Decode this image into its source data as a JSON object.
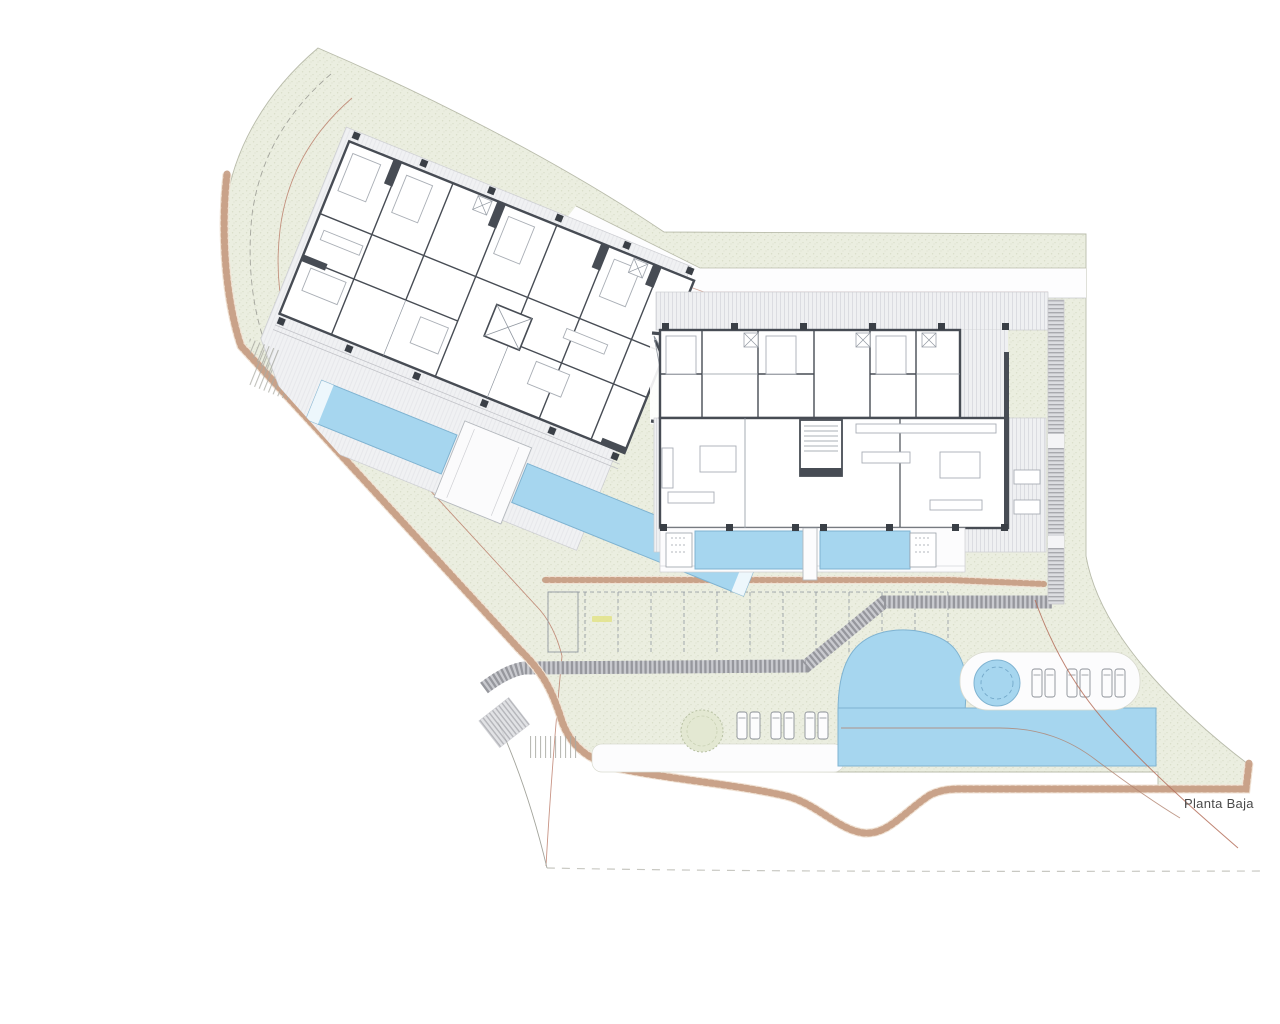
{
  "drawing": {
    "title": "Planta Baja"
  },
  "colors": {
    "paper": "#ffffff",
    "green": "#ebeee0",
    "greendot": "#d7dcc6",
    "greenedge": "#b9bcab",
    "platform": "#f0f1f3",
    "platedge": "#c8c9ce",
    "deck": "#eff0f2",
    "deckline": "#dbdce1",
    "wall": "#474c54",
    "wallsoft": "#9097a0",
    "furn": "#a9aeb5",
    "pool": "#a6d6ef",
    "pooledge": "#7fb3d1",
    "poolinner": "#74a9ca",
    "stone": "#c2977b",
    "stonebase": "#f0e2d4",
    "band": "#96979d",
    "bandbase": "#c9cacf",
    "contour": "#b5705c",
    "boundary": "#a3a49c",
    "elevation": "#e3e388",
    "text": "#4a4a4a",
    "white": "#fcfcfd",
    "treefill": "#e3e8d2",
    "treeline": "#b7c0a2",
    "column": "#3a3f46",
    "loungerline": "#8b9097"
  },
  "features": {
    "parking": {
      "stall_count": 12,
      "y1": 592,
      "y2": 652,
      "stall_xs": [
        585,
        618,
        651,
        684,
        717,
        750,
        783,
        816,
        849,
        882,
        915,
        948
      ]
    },
    "sun_loungers": {
      "groups": [
        {
          "target": "sun-loungers-left",
          "y": 712,
          "h": 27,
          "xs": [
            737,
            750,
            771,
            784,
            805,
            818
          ]
        },
        {
          "target": "sun-loungers-right",
          "y": 669,
          "h": 28,
          "xs": [
            1032,
            1045,
            1067,
            1080,
            1102,
            1115
          ]
        }
      ]
    },
    "pools": {
      "left_building_pools": 2,
      "right_building_pools": 2,
      "lagoon": 1,
      "spa": 1
    },
    "trees": 1
  },
  "labels": {
    "elevation_marks": [
      {
        "x": 592,
        "y": 616
      },
      {
        "x": 594,
        "y": 757
      },
      {
        "x": 806,
        "y": 758
      }
    ]
  }
}
